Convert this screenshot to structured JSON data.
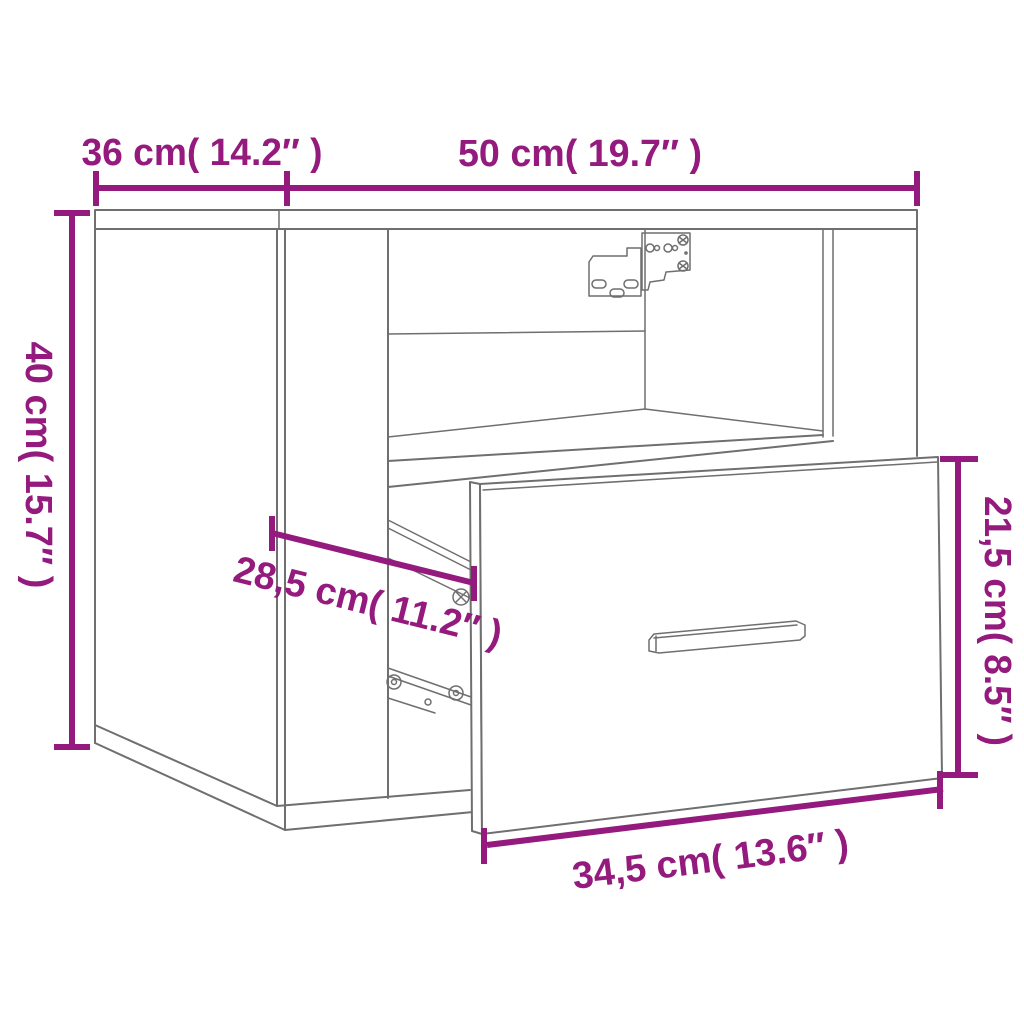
{
  "figure": {
    "type": "product-dimension-diagram",
    "background_color": "#ffffff",
    "outline_color": "#6f6f6f",
    "dimension_color": "#941A7E"
  },
  "dimensions": {
    "depth_top": {
      "label": "36 cm( 14.2″ )"
    },
    "width_top": {
      "label": "50 cm( 19.7″ )"
    },
    "height_left": {
      "label": "40 cm( 15.7″ )"
    },
    "drawer_height_right": {
      "label": "21,5 cm( 8.5″ )"
    },
    "inner_depth_middle": {
      "label": "28,5 cm( 11.2″ )"
    },
    "drawer_width_bottom": {
      "label": "34,5 cm( 13.6″ )"
    }
  }
}
